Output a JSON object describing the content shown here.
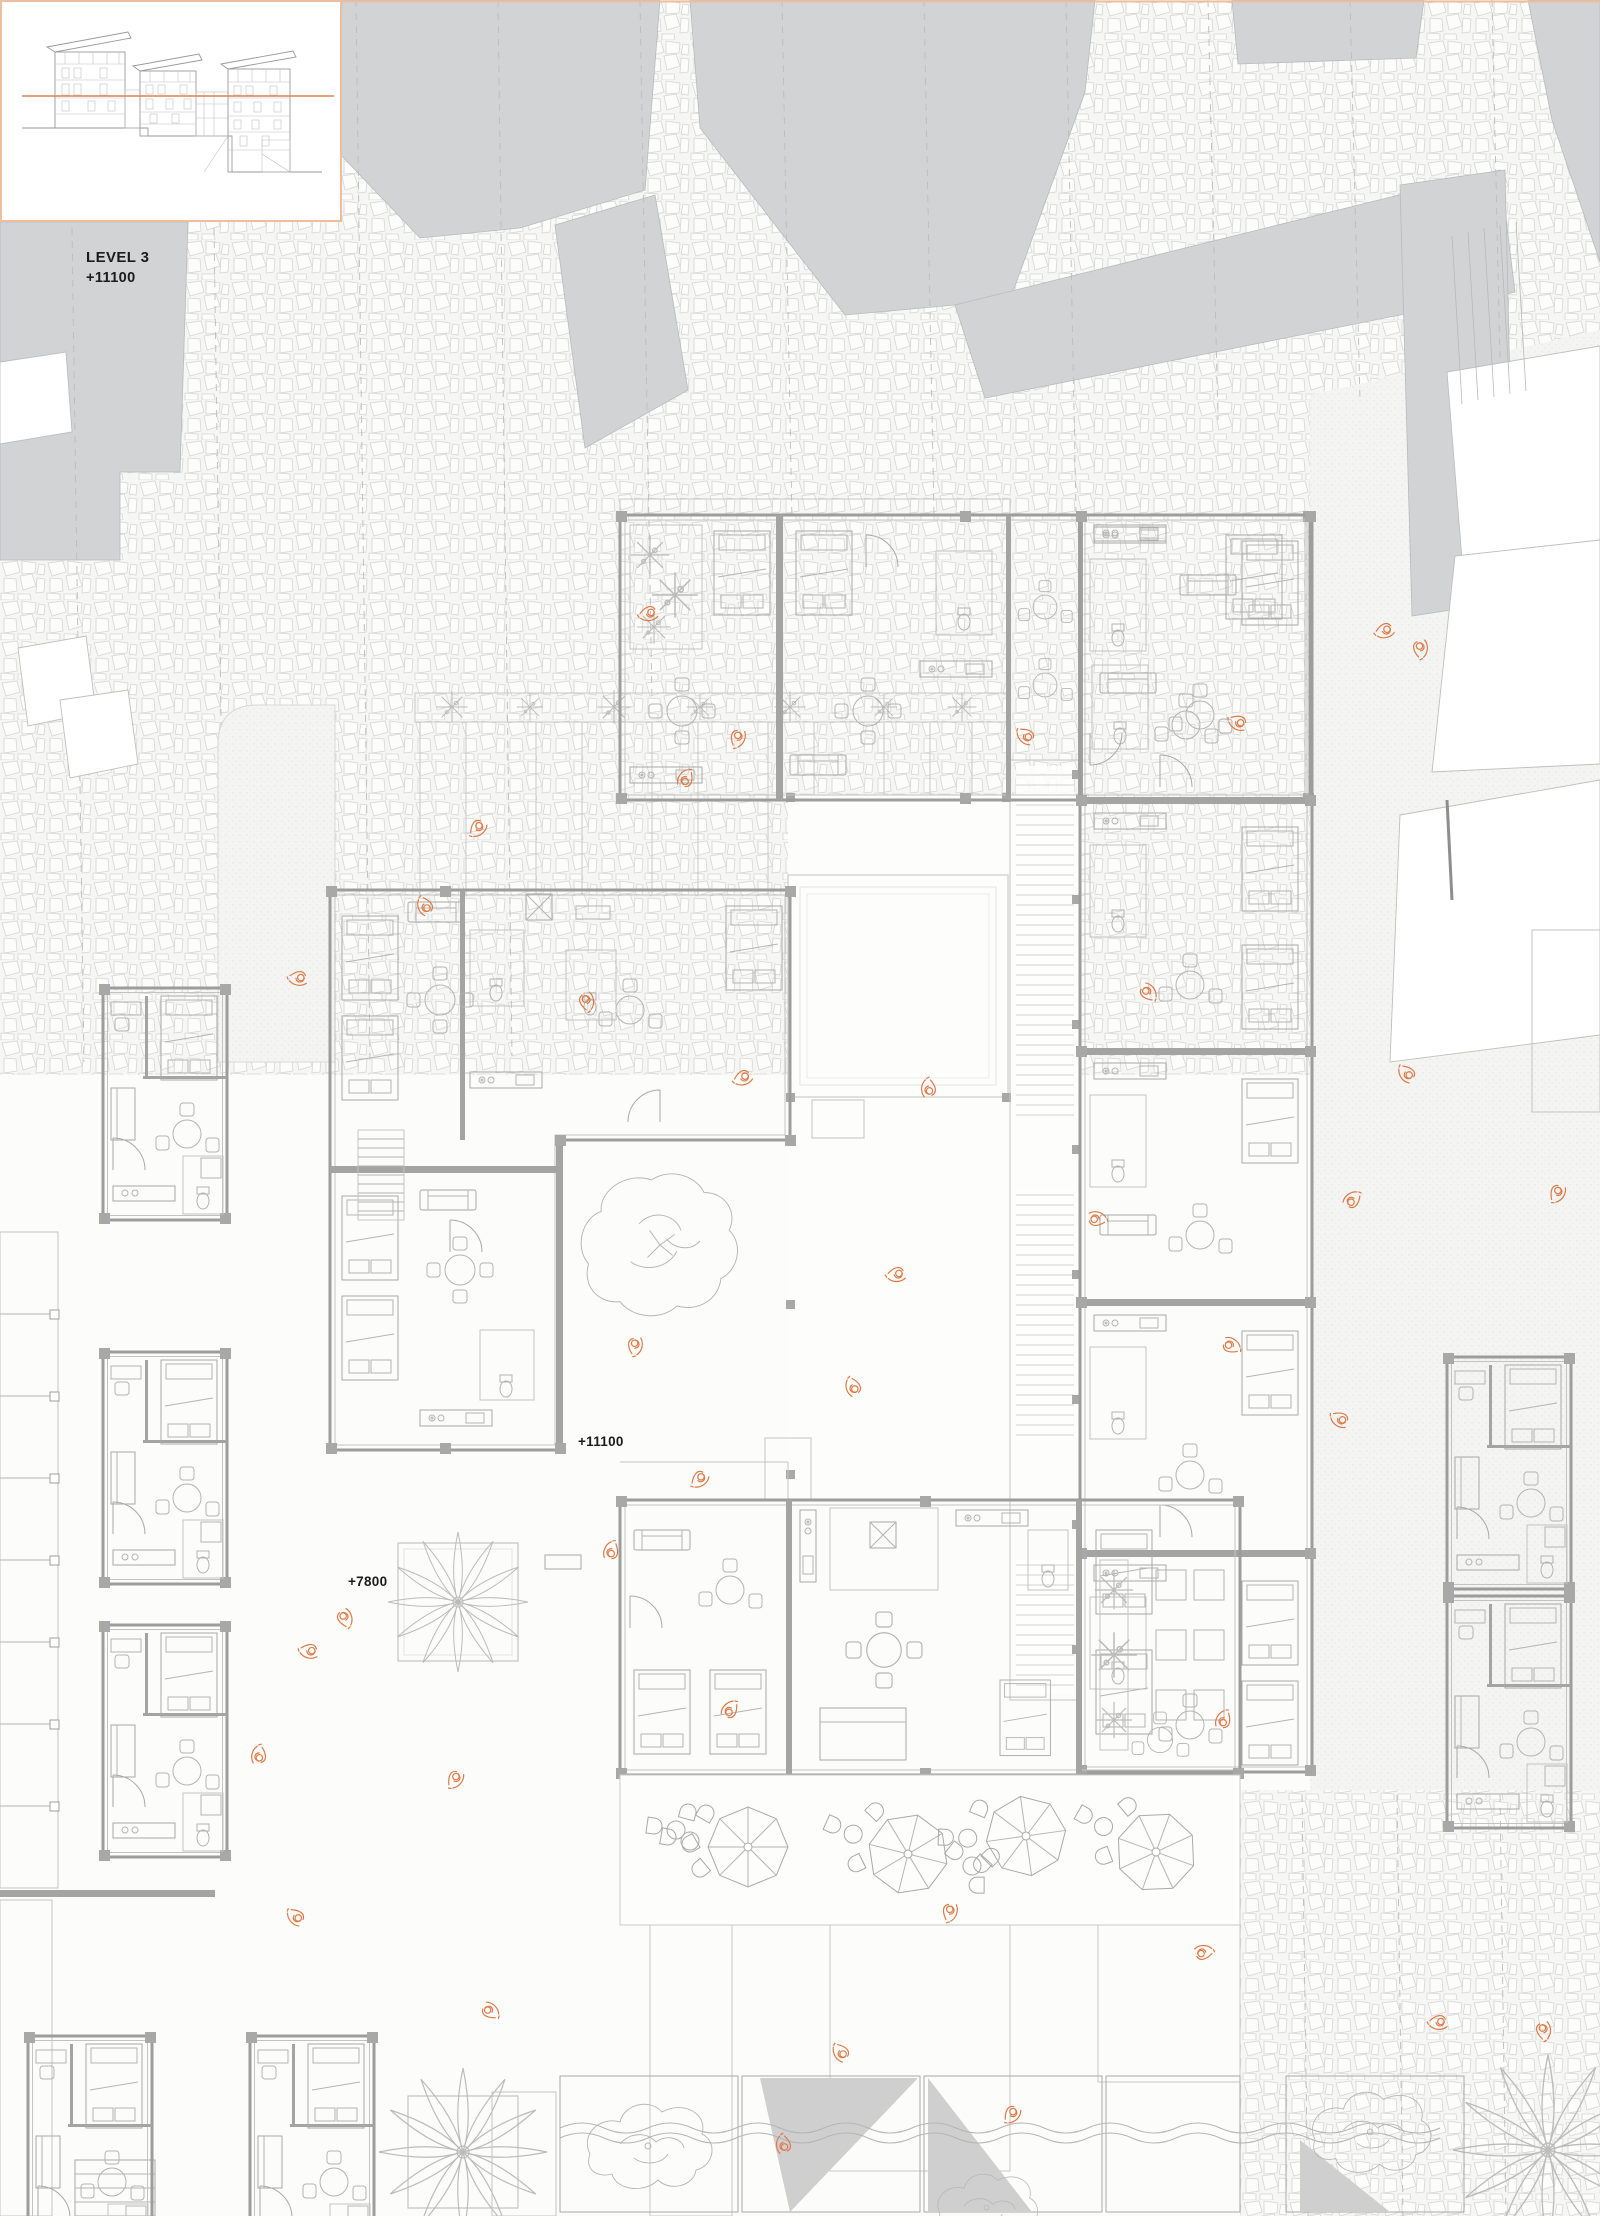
{
  "drawing": {
    "type": "architectural-floor-plan",
    "labels": {
      "level_title": "LEVEL 3",
      "level_value": "+11100",
      "plan_annotation_upper": "+11100",
      "plan_annotation_lower": "+7800"
    },
    "inset": {
      "name": "building-section-elevation-key",
      "depicts": "stepped building elevation with level line at +11100"
    },
    "colors": {
      "accent_orange": "#DE7F50",
      "accent_orange_light": "#EEBF9F",
      "context_building_gray": "#D2D3D5",
      "wall_gray": "#A4A4A4",
      "furniture_line_gray": "#B4B4B4",
      "cobblestone_line": "#D6D6D4",
      "background": "#FAFAF8",
      "plan_floor": "#FFFFFF"
    },
    "scene": {
      "umbrella_count": 4,
      "person_figure_count": 40,
      "palm_tree_count": 3,
      "round_tree_count": 2,
      "context_building_mass_count": 9
    }
  }
}
